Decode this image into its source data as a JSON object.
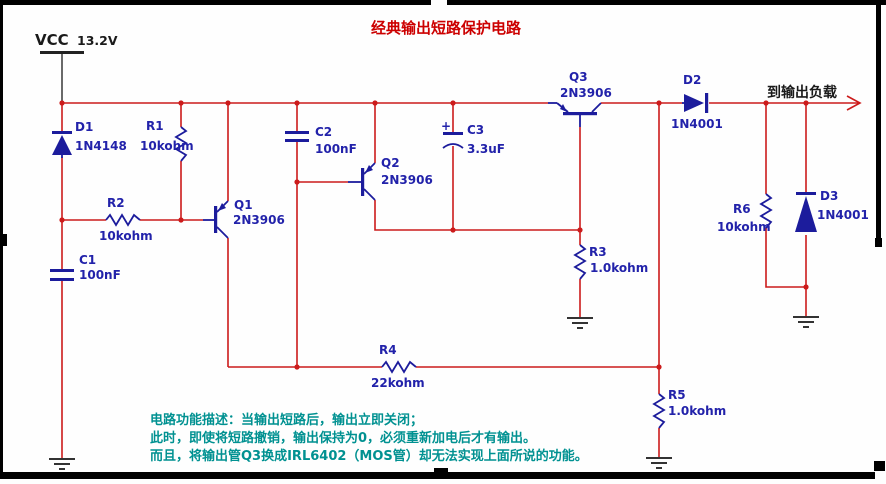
{
  "title": {
    "text": "经典输出短路保护电路",
    "color": "#cc0000"
  },
  "power": {
    "label": "VCC",
    "voltage": "13.2V"
  },
  "output": {
    "label": "到输出负载"
  },
  "components": {
    "d1": {
      "ref": "D1",
      "value": "1N4148"
    },
    "r1": {
      "ref": "R1",
      "value": "10kohm"
    },
    "r2": {
      "ref": "R2",
      "value": "10kohm"
    },
    "c1": {
      "ref": "C1",
      "value": "100nF"
    },
    "q1": {
      "ref": "Q1",
      "value": "2N3906"
    },
    "c2": {
      "ref": "C2",
      "value": "100nF"
    },
    "q2": {
      "ref": "Q2",
      "value": "2N3906"
    },
    "c3": {
      "ref": "C3",
      "value": "3.3uF",
      "polarity": "+"
    },
    "q3": {
      "ref": "Q3",
      "value": "2N3906"
    },
    "r3": {
      "ref": "R3",
      "value": "1.0kohm"
    },
    "r4": {
      "ref": "R4",
      "value": "22kohm"
    },
    "r5": {
      "ref": "R5",
      "value": "1.0kohm"
    },
    "r6": {
      "ref": "R6",
      "value": "10kohm"
    },
    "d2": {
      "ref": "D2",
      "value": "1N4001"
    },
    "d3": {
      "ref": "D3",
      "value": "1N4001"
    }
  },
  "description": {
    "line1": "电路功能描述：当输出短路后，输出立即关闭；",
    "line2": "此时，即使将短路撤销，输出保持为0，必须重新加电后才有输出。",
    "line3": "而且，将输出管Q3换成IRL6402（MOS管）却无法实现上面所说的功能。"
  },
  "colors": {
    "wire": "#cc1b1b",
    "component": "#1c1c9c",
    "label": "#2222aa",
    "title": "#cc0000",
    "description": "#009191",
    "frame": "#000000"
  }
}
